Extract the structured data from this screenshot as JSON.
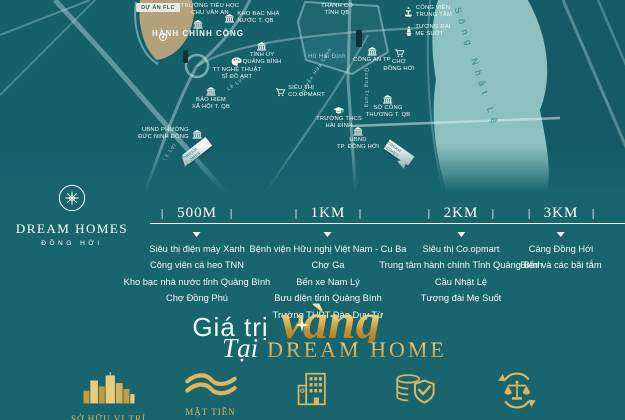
{
  "brand": {
    "logo_title": "DREAM HOMES",
    "logo_subtitle": "ĐỒNG HỚI"
  },
  "map": {
    "river_label": "Sông Nhật Lệ",
    "project_badge": "DỰ ÁN FLC",
    "marker_label": "DREAM HOMES",
    "pois": [
      {
        "id": "truong-tieu-hoc-chu-van-an",
        "icon": "",
        "pos": "none",
        "text": "TRƯỜNG TIỂU HỌC\nCHU VĂN AN",
        "x": 210,
        "y": 3
      },
      {
        "id": "kho-bac-nha-nuoc-t-qb",
        "icon": "gov",
        "pos": "left",
        "text": "KHO BẠC NHÀ\nNƯỚC T. QB",
        "x": 252,
        "y": 11
      },
      {
        "id": "hanh-chinh-cong",
        "icon": "gov",
        "pos": "top",
        "cls": "big",
        "text": "HÀNH CHÍNH CÔNG",
        "x": 198,
        "y": 20
      },
      {
        "id": "thanh-co-tinh-qb",
        "icon": "",
        "pos": "none",
        "text": "THÀNH CỔ\nTỈNH QB",
        "x": 337,
        "y": 3
      },
      {
        "id": "cong-vien-trung-tam",
        "icon": "fountain",
        "pos": "left",
        "text": "CÔNG VIÊN\nTRUNG TÂM",
        "x": 428,
        "y": 5
      },
      {
        "id": "tuong-dai-me-suot",
        "icon": "statue",
        "pos": "left",
        "text": "TƯỢNG ĐÀI\nMẸ SUỐT",
        "x": 428,
        "y": 24
      },
      {
        "id": "tinh-uy-quang-binh",
        "icon": "gov",
        "pos": "top",
        "text": "TỈNH ỦY\nQUẢNG BÌNH",
        "x": 262,
        "y": 42
      },
      {
        "id": "tt-nghe-thuat-si-do-art",
        "icon": "palette",
        "pos": "top",
        "text": "TT NGHỆ THUẬT\nSĨ ĐỒ ART",
        "x": 237,
        "y": 57
      },
      {
        "id": "ho-hai-dinh",
        "icon": "",
        "pos": "none",
        "cls": "water",
        "text": "Hồ Hải Định",
        "x": 327,
        "y": 54
      },
      {
        "id": "cong-an-tp",
        "icon": "gov",
        "pos": "top",
        "text": "CÔNG AN TP",
        "x": 372,
        "y": 47
      },
      {
        "id": "cho-dong-hoi",
        "icon": "cart",
        "pos": "top",
        "text": "CHỢ\nĐỒNG HỚI",
        "x": 399,
        "y": 49
      },
      {
        "id": "sieu-thi-coopmart",
        "icon": "cart",
        "pos": "left",
        "text": "SIÊU THỊ\nCO.OPMART",
        "x": 300,
        "y": 85
      },
      {
        "id": "bao-hiem-xa-hoi-t-qb",
        "icon": "gov",
        "pos": "top",
        "text": "BẢO HIỂM\nXÃ HỘI T. QB",
        "x": 211,
        "y": 87
      },
      {
        "id": "so-cong-thuong-t-qb",
        "icon": "gov",
        "pos": "top",
        "text": "SỞ CÔNG\nTHƯƠNG T. QB",
        "x": 388,
        "y": 95
      },
      {
        "id": "truong-thcs-hai-dinh",
        "icon": "cap",
        "pos": "top",
        "text": "TRƯỜNG THCS\nHẢI ĐÌNH",
        "x": 339,
        "y": 107
      },
      {
        "id": "ubnd-phuong-duc-ninh-dong",
        "icon": "gov",
        "pos": "right",
        "text": "UBND PHƯỜNG\nĐỨC NINH ĐÔNG",
        "x": 170,
        "y": 127
      },
      {
        "id": "ubnd-tp-dong-hoi",
        "icon": "gov",
        "pos": "top",
        "text": "UBND\nTP. ĐỒNG HỚI",
        "x": 358,
        "y": 127
      }
    ],
    "roads": [
      {
        "id": "le-loi-1",
        "text": "Lê Lợi",
        "x": 236,
        "y": 84,
        "rot": -35
      },
      {
        "id": "le-loi-2",
        "text": "Lê Lợi",
        "x": 170,
        "y": 152,
        "rot": -55
      },
      {
        "id": "quang-trung",
        "text": "Quang Trung",
        "x": 366,
        "y": 88,
        "rot": 90
      },
      {
        "id": "nguyen-huu-canh",
        "text": "Nguyễn Hữu Cảnh",
        "x": 316,
        "y": 72,
        "rot": -57
      }
    ]
  },
  "timeline": {
    "columns": [
      {
        "distance": "500M",
        "items": [
          "Siêu thị điện máy Xanh",
          "Công viên cá heo TNN",
          "Kho bạc nhà nước tỉnh Quảng Bình",
          "Chợ Đồng Phú"
        ]
      },
      {
        "distance": "1KM",
        "items": [
          "Bệnh viện Hữu nghị Việt Nam - Cu Ba",
          "Chợ Ga",
          "Bến xe Nam Lý",
          "Bưu điện tỉnh Quảng Bình",
          "Trường THPT Đào Duy Từ"
        ]
      },
      {
        "distance": "2KM",
        "items": [
          "Siêu thị Co.opmart",
          "Trung tâm hành chính Tỉnh Quảng Bình",
          "Cầu Nhật Lệ",
          "Tượng đài Mẹ Suốt"
        ]
      },
      {
        "distance": "3KM",
        "items": [
          "Cảng Đồng Hới",
          "Biển và các bãi tắm"
        ]
      }
    ]
  },
  "title": {
    "prefix": "Giá trị",
    "highlight": "vàng",
    "connector": "Tại",
    "brand": "DREAM HOME"
  },
  "features": [
    {
      "id": "vi-tri",
      "icon": "skyline",
      "label": "SỞ HỮU VỊ TRÍ"
    },
    {
      "id": "mat-tien",
      "icon": "waves",
      "label": "MẶT TIỀN"
    },
    {
      "id": "toa-nha",
      "icon": "building",
      "label": ""
    },
    {
      "id": "phap-ly",
      "icon": "shield-coins",
      "label": ""
    },
    {
      "id": "thanh-khoan",
      "icon": "scales",
      "label": ""
    }
  ],
  "colors": {
    "background": "#19656e",
    "river": "#8cc0c1",
    "gold": "#dcb75f",
    "flc_area": "#b2a17a"
  }
}
